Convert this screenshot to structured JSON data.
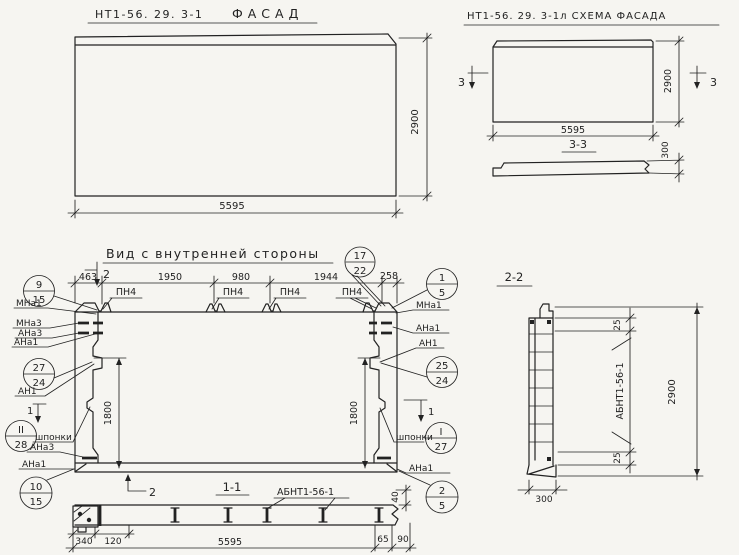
{
  "colors": {
    "paper": "#f6f5f1",
    "ink": "#222222"
  },
  "facade": {
    "code": "НТ1-56. 29. 3-1",
    "name": "ФАСАД",
    "width": "5595",
    "height": "2900"
  },
  "schema": {
    "title": "НТ1-56. 29. 3-1л СХЕМА ФАСАДА",
    "width": "5595",
    "height": "2900",
    "cut": "3",
    "section": "3-3",
    "thickness": "300"
  },
  "inner": {
    "title": "Вид с внутренней стороны",
    "cut1": "1",
    "cut2": "2",
    "dims": {
      "d463": "463",
      "d1950": "1950",
      "d980": "980",
      "d1944": "1944",
      "d258": "258",
      "d1800": "1800"
    },
    "labels": {
      "pn4": "ПН4",
      "mna1": "МНа1",
      "mna3": "МНа3",
      "ana3": "АНа3",
      "ana1": "АНа1",
      "an1": "АН1",
      "shponki": "шпонки"
    }
  },
  "callouts": {
    "c17_22": {
      "top": "17",
      "bot": "22"
    },
    "c9_15": {
      "top": "9",
      "bot": "15"
    },
    "c27_24": {
      "top": "27",
      "bot": "24"
    },
    "c2_28": {
      "top": "II",
      "bot": "28"
    },
    "c10_15": {
      "top": "10",
      "bot": "15"
    },
    "c1_5": {
      "top": "1",
      "bot": "5"
    },
    "c25_24": {
      "top": "25",
      "bot": "24"
    },
    "c1_27": {
      "top": "I",
      "bot": "27"
    },
    "c2_5": {
      "top": "2",
      "bot": "5"
    }
  },
  "section11": {
    "title": "1-1",
    "beam": "АБНТ1-56-1",
    "dims": {
      "d340": "340",
      "d120": "120",
      "d5595": "5595",
      "d40": "40",
      "d65": "65",
      "d90": "90"
    }
  },
  "section22": {
    "title": "2-2",
    "beam": "АБНТ1-56-1",
    "height": "2900",
    "width": "300",
    "edge": "25"
  }
}
